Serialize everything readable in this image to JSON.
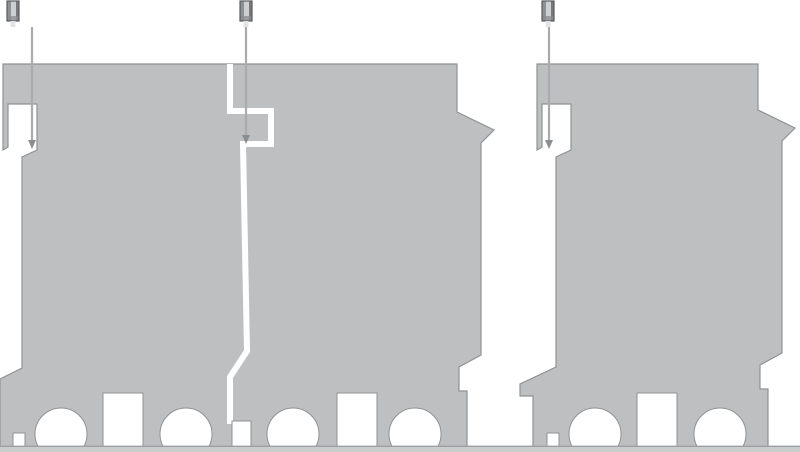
{
  "diagram": {
    "description": "Technical side-profile illustration of modular DIN-mount devices: two interlocked modules joined by a zigzag seam on the left, one separate module on the right, each with a fixing screw pin above and a leader line pointing into the top notch; bottom edge has round busbar holes and rectangular slots resting on a rail strip.",
    "canvas": {
      "width": 800,
      "height": 452
    },
    "colors": {
      "body": "#bdbfc1",
      "edge": "#8f9294",
      "white": "#ffffff",
      "rail": "#caccce",
      "railEdge": "#9da0a2",
      "leader": "#a9abad",
      "arrow": "#8c8f91",
      "screwDark": "#595c5e",
      "screwA": "#8e9193",
      "screwB": "#cdcfd1",
      "screwC": "#77797b",
      "screwBand": "#888b8d",
      "screwStub": "#e3e4e5"
    },
    "bodies": [
      {
        "name": "joined-module-pair-body",
        "d": "M 3 64 H 457 V 112 L 494 130 L 481 143 V 355 L 459 367 V 391 H 467 V 447 H 0 V 379 L 22 368 V 157 L 37 150 V 104 H 8 V 147 L 3 150 Z"
      },
      {
        "name": "single-module-body",
        "d": "M 537 64 H 758 V 110 L 795 128 L 782 141 V 353 L 760 365 V 389 H 768 V 447 H 533 V 396 H 520 V 384 L 556 367 V 157 L 571 150 V 104 H 542 V 147 L 537 150 Z"
      }
    ],
    "seam": {
      "name": "interlock-seam-gap",
      "d": "M 230 64 V 111 H 271 V 144 H 243 L 247 351 L 230 377 V 424",
      "width": 6
    },
    "cutouts": [
      {
        "kind": "rect",
        "name": "mounting-slot",
        "x": 13,
        "y": 433,
        "w": 12,
        "h": 14
      },
      {
        "kind": "circle",
        "name": "busbar-hole",
        "cx": 61,
        "cy": 434,
        "r": 26
      },
      {
        "kind": "rect",
        "name": "mounting-slot",
        "x": 103,
        "y": 393,
        "w": 40,
        "h": 54
      },
      {
        "kind": "circle",
        "name": "busbar-hole",
        "cx": 186,
        "cy": 434,
        "r": 26
      },
      {
        "kind": "rect",
        "name": "seam-bottom-slot",
        "x": 232,
        "y": 421,
        "w": 19,
        "h": 26
      },
      {
        "kind": "circle",
        "name": "busbar-hole",
        "cx": 293,
        "cy": 434,
        "r": 26
      },
      {
        "kind": "rect",
        "name": "mounting-slot",
        "x": 337,
        "y": 393,
        "w": 40,
        "h": 54
      },
      {
        "kind": "circle",
        "name": "busbar-hole",
        "cx": 415,
        "cy": 434,
        "r": 26
      },
      {
        "kind": "rect",
        "name": "mounting-slot",
        "x": 547,
        "y": 433,
        "w": 12,
        "h": 14
      },
      {
        "kind": "circle",
        "name": "busbar-hole",
        "cx": 595,
        "cy": 434,
        "r": 26
      },
      {
        "kind": "rect",
        "name": "mounting-slot",
        "x": 637,
        "y": 393,
        "w": 40,
        "h": 54
      },
      {
        "kind": "circle",
        "name": "busbar-hole",
        "cx": 720,
        "cy": 434,
        "r": 26
      }
    ],
    "rail": {
      "name": "mounting-rail-baseline",
      "x": 0,
      "y": 447,
      "w": 800,
      "h": 5,
      "edgeH": 1.4
    },
    "screws": [
      {
        "name": "fixing-screw-1",
        "x": 7,
        "y": 1,
        "w": 12,
        "h": 20
      },
      {
        "name": "fixing-screw-2",
        "x": 240,
        "y": 1,
        "w": 12,
        "h": 20
      },
      {
        "name": "fixing-screw-3",
        "x": 542,
        "y": 1,
        "w": 12,
        "h": 20
      }
    ],
    "leaders": [
      {
        "name": "screw-axis-leader-1",
        "x": 32,
        "y1": 27,
        "y2": 140
      },
      {
        "name": "screw-axis-leader-2",
        "x": 246,
        "y1": 27,
        "y2": 135
      },
      {
        "name": "screw-axis-leader-3",
        "x": 549,
        "y1": 27,
        "y2": 140
      }
    ],
    "arrowSize": {
      "halfWidth": 4,
      "length": 9
    }
  }
}
